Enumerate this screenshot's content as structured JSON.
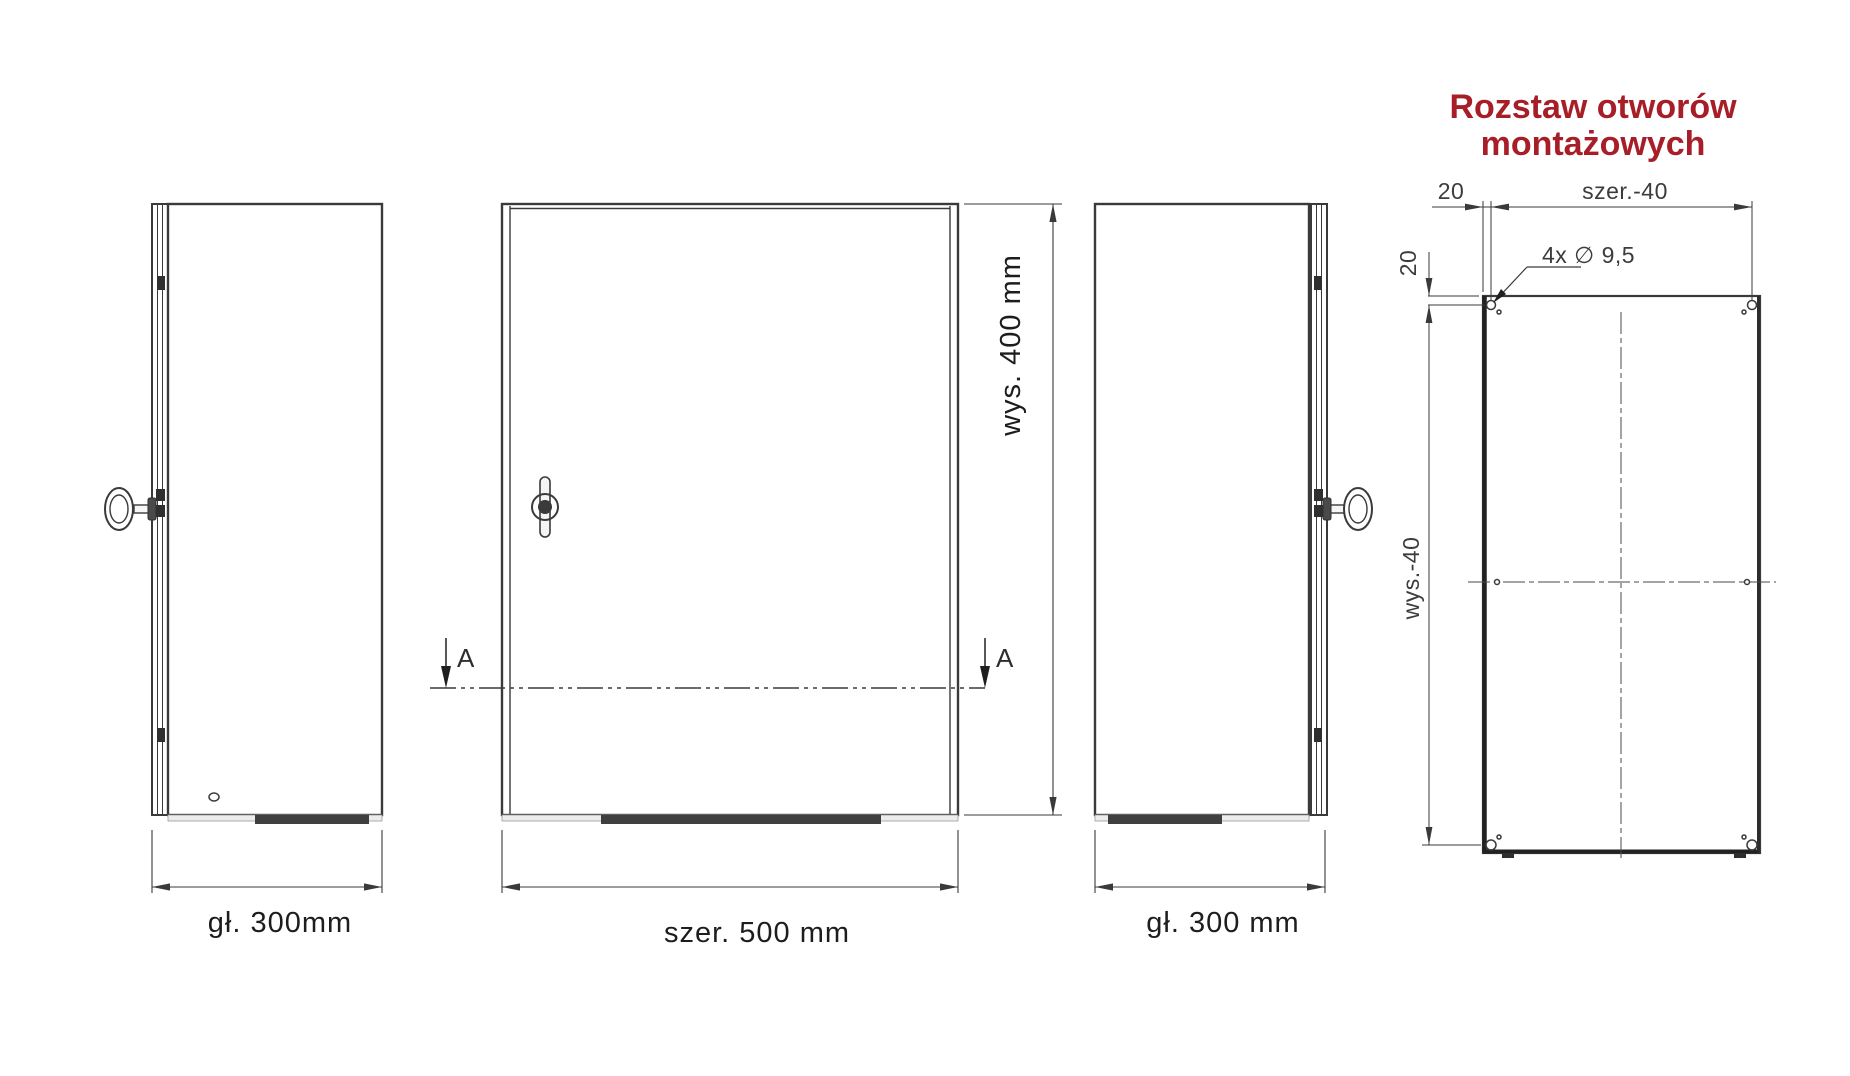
{
  "title": {
    "line1": "Rozstaw otworów",
    "line2": "montażowych",
    "color": "#a71e28"
  },
  "views": {
    "left_side": {
      "label": "gł. 300mm"
    },
    "front": {
      "label_width": "szer. 500 mm",
      "label_height": "wys. 400 mm",
      "section_marker": "A"
    },
    "right_side": {
      "label": "gł. 300 mm"
    }
  },
  "mounting_plate": {
    "dim_top_offset": "20",
    "dim_left_offset": "20",
    "dim_width": "szer.-40",
    "dim_height": "wys.-40",
    "holes_note": "4x ∅ 9,5"
  },
  "colors": {
    "line": "#3a3a3a",
    "accent": "#a71e28"
  }
}
